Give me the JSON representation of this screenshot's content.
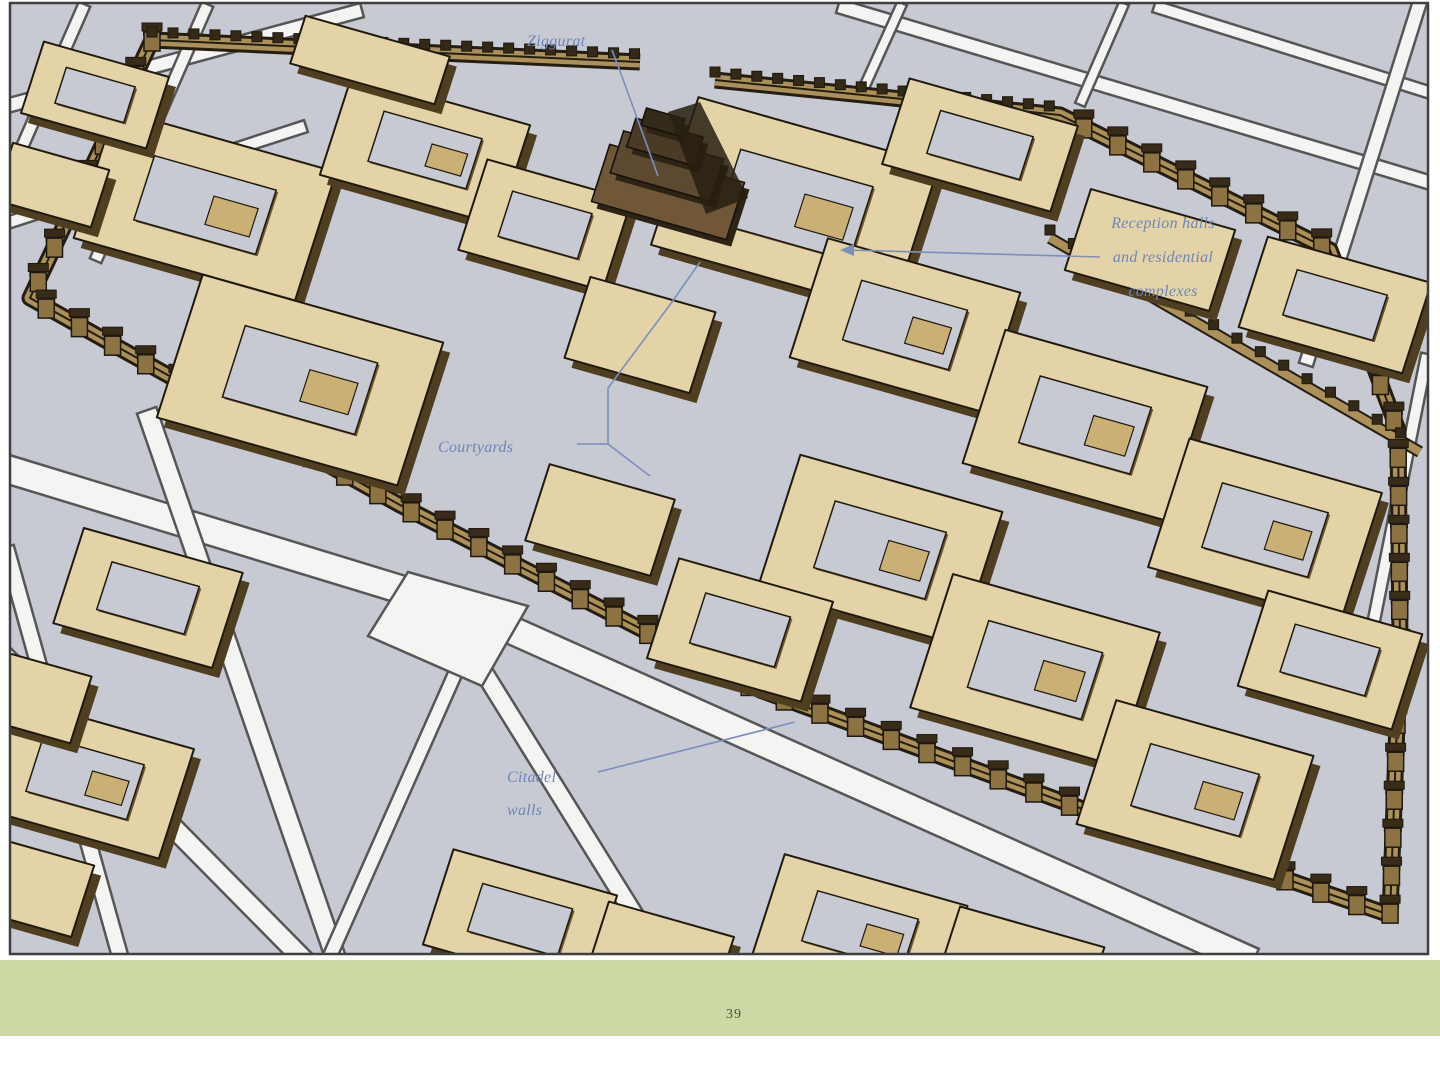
{
  "figure": {
    "labels": {
      "ziggurat": {
        "text": "Ziggurat"
      },
      "reception": {
        "lines": [
          "Reception halls",
          "and residential",
          "complexes"
        ]
      },
      "courtyards": {
        "text": "Courtyards"
      },
      "citadel_walls": {
        "lines": [
          "Citadel",
          "walls"
        ]
      }
    },
    "colors": {
      "label_blue": "#6e86ba",
      "ground_gray": "#c7cad2",
      "roof_tan": "#e4d3a6",
      "wall_brown": "#8d7342",
      "footer_green": "#cdd9a4",
      "page_number_olive": "#4a5130"
    }
  },
  "footer": {
    "page_number": "39"
  }
}
